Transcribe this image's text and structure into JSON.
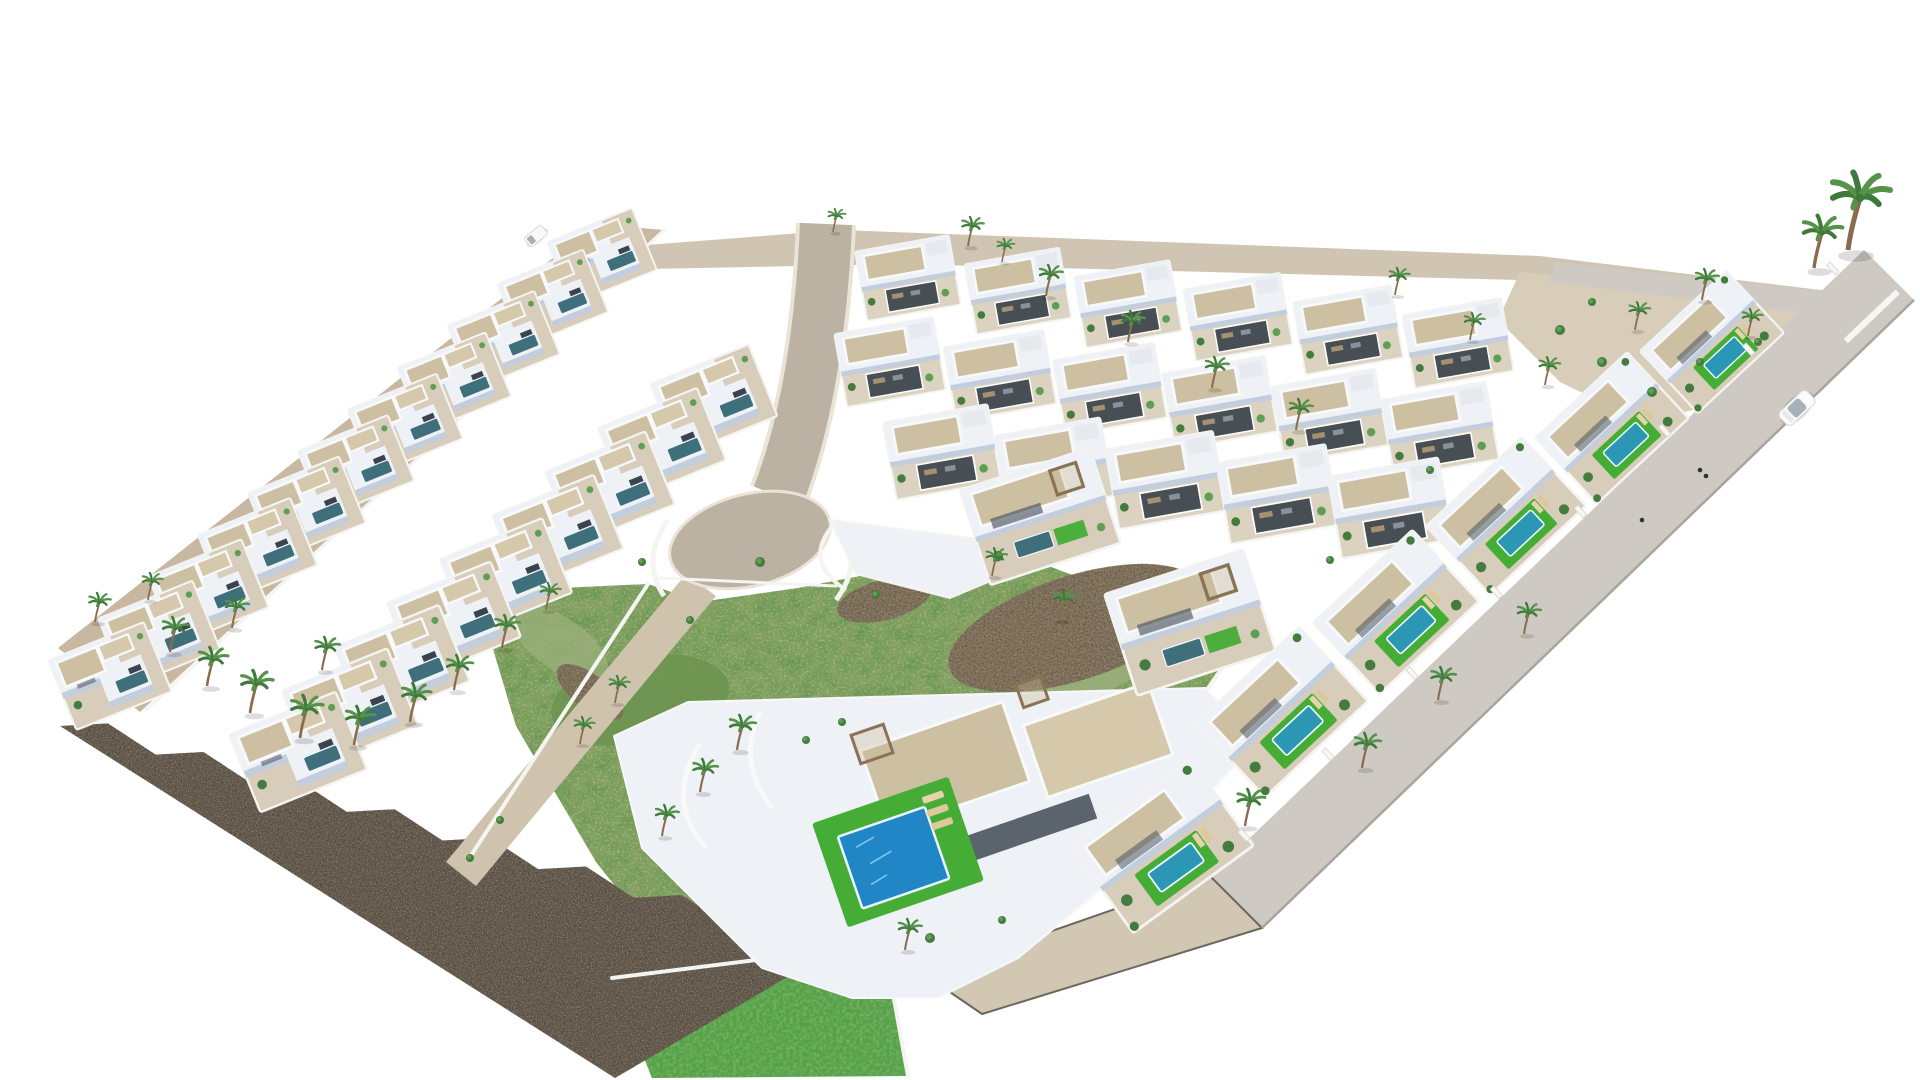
{
  "meta": {
    "canvas_width": 1920,
    "canvas_height": 1080,
    "background": "#ffffff"
  },
  "palette": {
    "bg": "#ffffff",
    "ground_light": "#cfc5b2",
    "gravel": "#d8cdb9",
    "road_beige": "#c8b7a1",
    "road_grey": "#cecac3",
    "road_grey_dark": "#c5beb1",
    "ramp_beige": "#d2c7b2",
    "road_tan": "#bcb2a3",
    "curb": "#eae3d6",
    "curb_dark": "#6b675f",
    "walk": "#cfc3ae",
    "stone": "#695f53",
    "scrub": "#83a060",
    "scrub_dark": "#6d9350",
    "scrub_light": "#9cb07d",
    "rocky": "#8b7a64",
    "lawn": "#45ad36",
    "lawn_deep": "#55a048",
    "villa_white": "#eef1f5",
    "villa_shade": "#c2cedd",
    "villa_dark": "#3a434e",
    "plot": "#d8cdbb",
    "plot_grid": "#dbd2c0",
    "roof_tan": "#cdbfa1",
    "roof_tan2": "#d5c8ab",
    "wall_white": "#f4f4f1",
    "court_dark": "#474e54",
    "pool_teal": "#3e6f7b",
    "pool_bright": "#2b97b4",
    "pool_blue": "#2186c6",
    "pool_glint": "#7ec8ec",
    "palm_green": "#3e7a39",
    "palm_green2": "#55924a",
    "trunk": "#8a6b4c",
    "pergola": "#8a7355",
    "shrub": "#447c3f",
    "shrub2": "#5f9e55",
    "car_white": "#fbfbfb",
    "car_glass": "#a7b1ba",
    "lounger": "#e6d3a8",
    "shadow": "#00000022"
  },
  "scene": {
    "areas": [
      {
        "name": "top-ground-strip",
        "fill": "ground_light",
        "pts": [
          [
            556,
            252
          ],
          [
            840,
            230
          ],
          [
            1540,
            256
          ],
          [
            1886,
            298
          ],
          [
            1852,
            320
          ],
          [
            1520,
            280
          ],
          [
            900,
            264
          ],
          [
            600,
            270
          ]
        ]
      },
      {
        "name": "top-right-garden",
        "fill": "gravel",
        "pts": [
          [
            1520,
            272
          ],
          [
            1862,
            310
          ],
          [
            1802,
            384
          ],
          [
            1642,
            422
          ],
          [
            1560,
            382
          ],
          [
            1498,
            320
          ]
        ]
      },
      {
        "name": "green-scrub-plot",
        "fill": "scrub",
        "filter": "grassTex",
        "pts": [
          [
            476,
            592
          ],
          [
            648,
            584
          ],
          [
            700,
            602
          ],
          [
            798,
            588
          ],
          [
            912,
            566
          ],
          [
            1022,
            556
          ],
          [
            1128,
            596
          ],
          [
            1236,
            648
          ],
          [
            1150,
            770
          ],
          [
            1028,
            900
          ],
          [
            942,
            980
          ],
          [
            850,
            1000
          ],
          [
            770,
            980
          ],
          [
            668,
            952
          ],
          [
            596,
            862
          ],
          [
            516,
            726
          ]
        ]
      },
      {
        "name": "bottom-lawn-garden",
        "fill": "lawn_deep",
        "filter": "lawnTex",
        "pts": [
          [
            612,
            978
          ],
          [
            884,
            944
          ],
          [
            908,
            1076
          ],
          [
            652,
            1078
          ]
        ]
      }
    ],
    "scrub_blobs": [
      {
        "cx": 640,
        "cy": 700,
        "rx": 90,
        "ry": 44,
        "rot": -10,
        "fill": "scrub_dark",
        "op": 0.9
      },
      {
        "cx": 900,
        "cy": 762,
        "rx": 108,
        "ry": 48,
        "rot": -12,
        "fill": "scrub_dark",
        "op": 0.7
      },
      {
        "cx": 1080,
        "cy": 662,
        "rx": 78,
        "ry": 36,
        "rot": -15,
        "fill": "scrub_light",
        "op": 0.8
      },
      {
        "cx": 560,
        "cy": 644,
        "rx": 56,
        "ry": 26,
        "rot": 35,
        "fill": "scrub_light",
        "op": 0.7
      }
    ],
    "rocky_patches": [
      {
        "cx": 1075,
        "cy": 628,
        "rx": 132,
        "ry": 52,
        "rot": -18
      },
      {
        "cx": 884,
        "cy": 600,
        "rx": 48,
        "ry": 20,
        "rot": -14
      },
      {
        "cx": 590,
        "cy": 692,
        "rx": 40,
        "ry": 17,
        "rot": 38
      }
    ],
    "stone_wall": {
      "a": [
        60,
        726
      ],
      "b": [
        825,
        955
      ],
      "v": [
        615,
        1078
      ],
      "teeth": 8,
      "tooth_h": 17
    },
    "roads": {
      "left_road": [
        [
          596,
          224
        ],
        [
          664,
          230
        ],
        [
          140,
          712
        ],
        [
          58,
          648
        ]
      ],
      "right_road": [
        [
          1864,
          250
        ],
        [
          1914,
          300
        ],
        [
          1262,
          928
        ],
        [
          1210,
          876
        ]
      ],
      "top_right_road": [
        [
          1556,
          262
        ],
        [
          1886,
          298
        ],
        [
          1868,
          320
        ],
        [
          1548,
          282
        ]
      ],
      "bottom_ramp": [
        [
          1210,
          876
        ],
        [
          1262,
          928
        ],
        [
          982,
          1014
        ],
        [
          925,
          975
        ]
      ],
      "walkway": [
        [
          686,
          574
        ],
        [
          716,
          596
        ],
        [
          476,
          886
        ],
        [
          446,
          862
        ]
      ],
      "central_path": "M826,224 C822,320 808,420 778,496",
      "central_width": 52,
      "curb_width": 60,
      "bulb": {
        "cx": 750,
        "cy": 540,
        "rx": 82,
        "ry": 46,
        "rot": -14
      },
      "outer_edge_line": [
        [
          1914,
          300
        ],
        [
          1262,
          928
        ]
      ],
      "zebra": {
        "x": 1888,
        "y": 301,
        "dx": -8.1,
        "dy": 7.7,
        "n": 5,
        "rot": 46.5,
        "w": 6,
        "len": 27
      }
    },
    "white_terrace": {
      "pts": [
        [
          830,
          520
        ],
        [
          986,
          540
        ],
        [
          1012,
          572
        ],
        [
          950,
          598
        ],
        [
          856,
          574
        ]
      ],
      "arc": "M836,522 Q800,560 846,590"
    },
    "walls": [
      {
        "pts": [
          [
            664,
            230
          ],
          [
            146,
            710
          ]
        ],
        "w": 3
      },
      {
        "pts": [
          [
            648,
            584
          ],
          [
            472,
            854
          ]
        ],
        "w": 4
      },
      {
        "pts": [
          [
            660,
            578
          ],
          [
            836,
            586
          ]
        ],
        "w": 3
      },
      {
        "pts": [
          [
            1236,
            648
          ],
          [
            1048,
            918
          ]
        ],
        "w": 4
      },
      {
        "pts": [
          [
            612,
            978
          ],
          [
            884,
            944
          ],
          [
            908,
            1076
          ]
        ],
        "w": 4
      }
    ],
    "bulb_flanks": [
      "M668,520 Q640,560 664,596",
      "M838,520 Q866,560 836,600"
    ],
    "big_villa": {
      "platform": [
        [
          614,
          736
        ],
        [
          688,
          702
        ],
        [
          1205,
          688
        ],
        [
          1258,
          742
        ],
        [
          1178,
          826
        ],
        [
          1018,
          958
        ],
        [
          938,
          998
        ],
        [
          852,
          998
        ],
        [
          762,
          968
        ],
        [
          642,
          848
        ]
      ],
      "roofs": [
        {
          "x": 945,
          "y": 766,
          "w": 150,
          "h": 84,
          "rot": -19,
          "fill": "roof_tan"
        },
        {
          "x": 1098,
          "y": 740,
          "w": 132,
          "h": 76,
          "rot": -19,
          "fill": "roof_tan2"
        }
      ],
      "veranda": {
        "x": 1006,
        "y": 836,
        "w": 184,
        "h": 26,
        "rot": -19
      },
      "pergolas": [
        {
          "x": 872,
          "y": 744,
          "w": 34,
          "h": 30,
          "rot": -19
        },
        {
          "x": 1032,
          "y": 692,
          "w": 26,
          "h": 24,
          "rot": -19
        },
        {
          "x": 1216,
          "y": 612,
          "w": 24,
          "h": 22,
          "rot": -19
        }
      ],
      "curves": [
        "M700,744 Q664,800 706,848",
        "M760,712 Q736,762 772,808"
      ],
      "lawn": {
        "x": 898,
        "y": 852,
        "rot": -19,
        "w": 144,
        "h": 110,
        "pool_w": 92,
        "pool_h": 76
      }
    },
    "villa_rows": [
      {
        "variant": "left",
        "start": [
          602,
          256
        ],
        "step": [
          -49.2,
          42
        ],
        "n": 11,
        "rot": -22,
        "scale": 0.95,
        "scale_step": 0.012
      },
      {
        "variant": "left",
        "start": [
          714,
          400
        ],
        "step": [
          -52,
          44
        ],
        "n": 9,
        "rot": -22,
        "scale": 1.1,
        "scale_step": 0.012
      },
      {
        "variant": "grid",
        "start": [
          908,
          278
        ],
        "step": [
          110,
          13
        ],
        "n": 6,
        "rot": -10,
        "scale": 0.95,
        "scale_step": 0.01
      },
      {
        "variant": "grid",
        "start": [
          890,
          362
        ],
        "step": [
          110,
          13.5
        ],
        "n": 6,
        "rot": -10,
        "scale": 1.0,
        "scale_step": 0.012
      },
      {
        "variant": "grid",
        "start": [
          942,
          452
        ],
        "step": [
          112,
          14
        ],
        "n": 5,
        "rot": -10,
        "scale": 1.06,
        "scale_step": 0.015
      }
    ],
    "villas_single": [
      {
        "variant": "hill",
        "x": 1040,
        "y": 516,
        "rot": -18,
        "scale": 1.05
      },
      {
        "variant": "hill",
        "x": 1190,
        "y": 622,
        "rot": -18,
        "scale": 1.12
      },
      {
        "variant": "outer",
        "x": 1712,
        "y": 342,
        "rot": -43,
        "scale": 0.92
      },
      {
        "variant": "outer",
        "x": 1612,
        "y": 428,
        "rot": -43,
        "scale": 0.98
      },
      {
        "variant": "outer",
        "x": 1506,
        "y": 516,
        "rot": -43,
        "scale": 1.02
      },
      {
        "variant": "outer",
        "x": 1396,
        "y": 612,
        "rot": -43,
        "scale": 1.06
      },
      {
        "variant": "outer",
        "x": 1282,
        "y": 712,
        "rot": -43,
        "scale": 1.1
      },
      {
        "variant": "outer",
        "x": 1162,
        "y": 846,
        "rot": -36,
        "scale": 1.16
      }
    ],
    "palms": [
      [
        95,
        622,
        0.75
      ],
      [
        148,
        600,
        0.7
      ],
      [
        170,
        652,
        0.9
      ],
      [
        207,
        686,
        1.0
      ],
      [
        250,
        713,
        1.1
      ],
      [
        300,
        738,
        1.1
      ],
      [
        354,
        745,
        1.0
      ],
      [
        410,
        722,
        1.0
      ],
      [
        454,
        690,
        0.9
      ],
      [
        502,
        648,
        0.85
      ],
      [
        546,
        610,
        0.7
      ],
      [
        232,
        628,
        0.8
      ],
      [
        322,
        670,
        0.85
      ],
      [
        615,
        703,
        0.7
      ],
      [
        580,
        744,
        0.7
      ],
      [
        737,
        750,
        0.9
      ],
      [
        700,
        792,
        0.85
      ],
      [
        662,
        836,
        0.8
      ],
      [
        968,
        246,
        0.75
      ],
      [
        1046,
        296,
        0.8
      ],
      [
        1128,
        342,
        0.8
      ],
      [
        1212,
        388,
        0.8
      ],
      [
        1296,
        430,
        0.8
      ],
      [
        1395,
        295,
        0.7
      ],
      [
        1470,
        340,
        0.7
      ],
      [
        1545,
        385,
        0.72
      ],
      [
        1635,
        330,
        0.72
      ],
      [
        1702,
        300,
        0.8
      ],
      [
        1748,
        336,
        0.7
      ],
      [
        1848,
        250,
        2.0
      ],
      [
        1814,
        268,
        1.35
      ],
      [
        1245,
        826,
        0.95
      ],
      [
        1362,
        768,
        0.9
      ],
      [
        1438,
        700,
        0.85
      ],
      [
        1524,
        634,
        0.8
      ],
      [
        1060,
        620,
        0.8
      ],
      [
        992,
        576,
        0.72
      ],
      [
        905,
        950,
        0.8
      ],
      [
        833,
        232,
        0.6
      ],
      [
        1002,
        262,
        0.6
      ]
    ],
    "shrubs": [
      [
        760,
        562,
        5
      ],
      [
        642,
        562,
        4
      ],
      [
        500,
        820,
        4
      ],
      [
        470,
        858,
        4
      ],
      [
        1560,
        330,
        5
      ],
      [
        1602,
        362,
        5
      ],
      [
        1652,
        392,
        5
      ],
      [
        1700,
        362,
        4
      ],
      [
        1758,
        342,
        4
      ],
      [
        1592,
        302,
        4
      ],
      [
        930,
        938,
        5
      ],
      [
        1002,
        920,
        4
      ],
      [
        806,
        740,
        4
      ],
      [
        842,
        722,
        4
      ],
      [
        1330,
        560,
        4
      ],
      [
        1430,
        470,
        4
      ],
      [
        876,
        595,
        4
      ],
      [
        690,
        620,
        4
      ]
    ],
    "posts": {
      "from": [
        1858,
        256
      ],
      "to": [
        1218,
        872
      ],
      "n": 8,
      "w": 5,
      "h": 13,
      "rot": -43
    },
    "car": {
      "x": 1797,
      "y": 408,
      "rot": 136.5
    },
    "van": {
      "x": 536,
      "y": 236,
      "rot": -40
    },
    "figures": [
      [
        1700,
        470
      ],
      [
        1706,
        476
      ],
      [
        1642,
        520
      ]
    ]
  }
}
